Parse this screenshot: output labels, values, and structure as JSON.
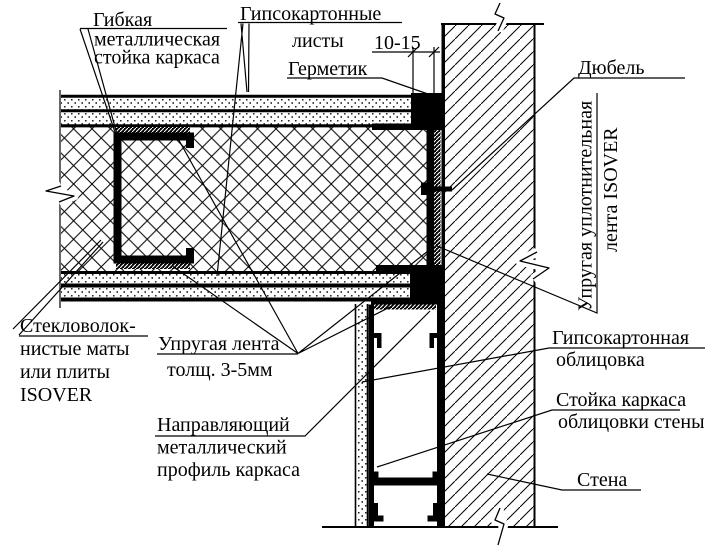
{
  "drawing": {
    "type": "construction-detail",
    "colors": {
      "line": "#000000",
      "background": "#ffffff"
    }
  },
  "labels": {
    "flexible_stud": {
      "lines": [
        "Гибкая",
        "металлическая",
        "стойка каркаса"
      ]
    },
    "gypsum_sheets": {
      "lines": [
        "Гипсокартонные",
        "листы"
      ]
    },
    "dimension": {
      "text": "10-15"
    },
    "sealant": {
      "text": "Герметик"
    },
    "dowel": {
      "text": "Дюбель"
    },
    "isover_tape": {
      "lines": [
        "Упругая уплотнительная",
        "лента ISOVER"
      ]
    },
    "glass_mats": {
      "lines": [
        "Стекловолок-",
        "нистые маты",
        "или плиты",
        "ISOVER"
      ]
    },
    "elastic_tape": {
      "lines": [
        "Упругая лента",
        "толщ. 3-5мм"
      ]
    },
    "guide_profile": {
      "lines": [
        "Направляющий",
        "металлический",
        "профиль каркаса"
      ]
    },
    "gypsum_cladding": {
      "lines": [
        "Гипсокартонная",
        "облицовка"
      ]
    },
    "cladding_stud": {
      "lines": [
        "Стойка каркаса",
        "облицовки стены"
      ]
    },
    "wall": {
      "text": "Стена"
    }
  }
}
